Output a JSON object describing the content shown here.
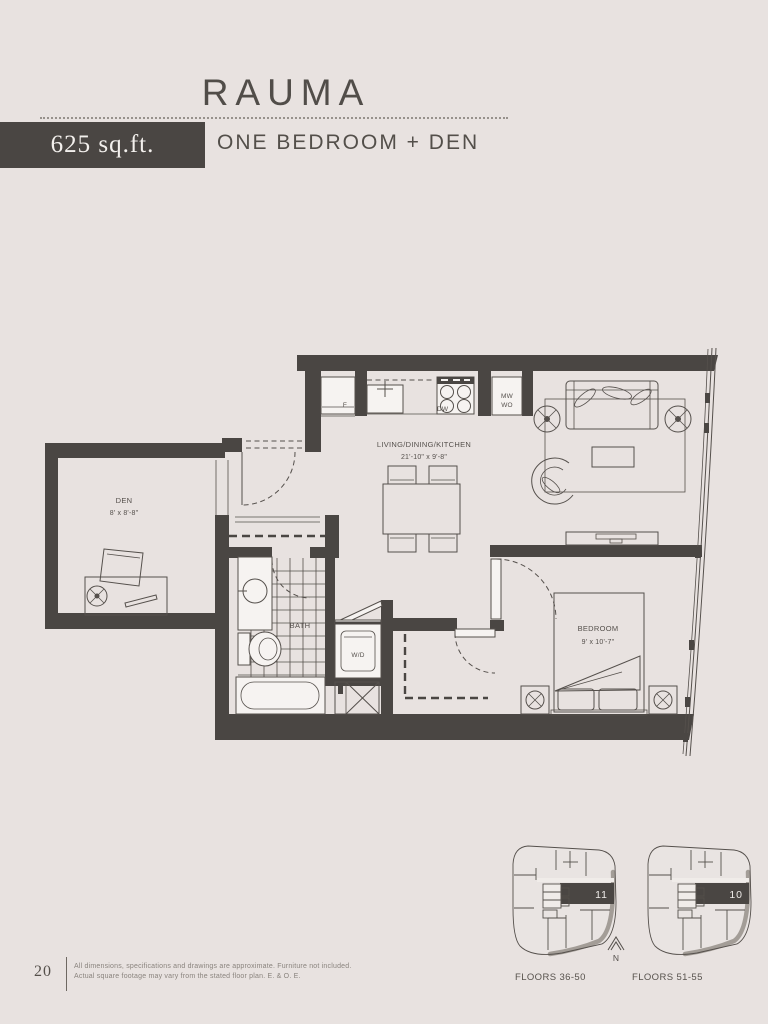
{
  "header": {
    "title": "RAUMA",
    "area_label": "625 sq.ft.",
    "subtitle": "ONE BEDROOM + DEN"
  },
  "plan": {
    "living": {
      "name": "LIVING/DINING/KITCHEN",
      "dims": "21'-10\" x 9'-8\""
    },
    "den": {
      "name": "DEN",
      "dims": "8' x 8'-8\""
    },
    "bedroom": {
      "name": "BEDROOM",
      "dims": "9' x 10'-7\""
    },
    "bath": {
      "name": "BATH"
    },
    "laundry": {
      "name": "W/D"
    },
    "appliances": {
      "fridge": "F",
      "dishwasher": "DW",
      "microwave": "MW",
      "wall_oven": "WO"
    }
  },
  "keyplans": {
    "left": {
      "unit": "11",
      "floors": "FLOORS 36-50"
    },
    "right": {
      "unit": "10",
      "floors": "FLOORS 51-55"
    },
    "north": "N"
  },
  "footer": {
    "page_number": "20",
    "disclaimer_line1": "All dimensions, specifications and drawings are approximate. Furniture not included.",
    "disclaimer_line2": "Actual square footage may vary from the stated floor plan. E. & O. E."
  },
  "colors": {
    "background": "#e8e2e0",
    "wall": "#4a4643",
    "line": "#55504c",
    "badge": "#4a4643"
  }
}
